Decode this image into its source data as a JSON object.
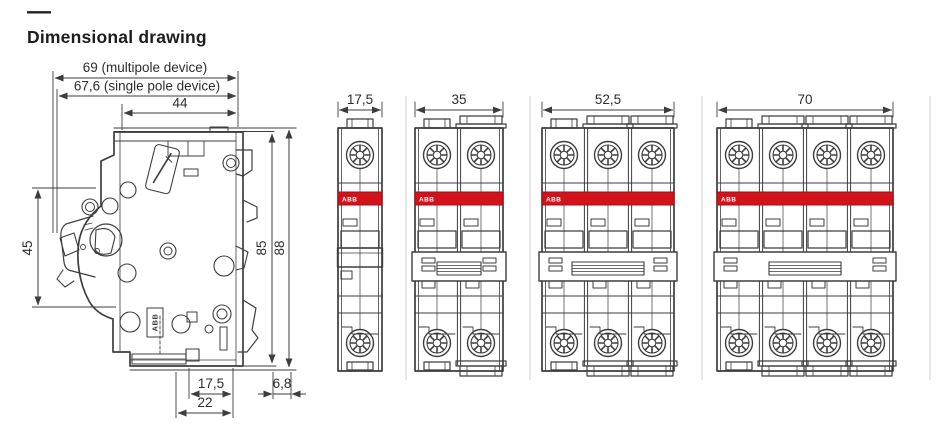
{
  "header": {
    "dash": "—",
    "title": "Dimensional drawing"
  },
  "colors": {
    "line": "#3d3d3d",
    "dim_line": "#3d3d3d",
    "text": "#2d2d2d",
    "brand_red": "#d2131b",
    "brand_red_border": "#a80d13",
    "separator": "#cfcfcf",
    "white": "#ffffff"
  },
  "side_view": {
    "dims_top": [
      {
        "id": "dim-69",
        "label": "69 (multipole device)"
      },
      {
        "id": "dim-67-6",
        "label": "67,6 (single pole device)"
      },
      {
        "id": "dim-44",
        "label": "44"
      }
    ],
    "dim_left": {
      "label": "45"
    },
    "dims_right": [
      {
        "label": "85"
      },
      {
        "label": "88"
      }
    ],
    "dims_bottom": [
      {
        "label": "17,5"
      },
      {
        "label": "6,8"
      },
      {
        "label": "22"
      }
    ],
    "brand_label": "ABB"
  },
  "front_views": [
    {
      "poles": 1,
      "width_label": "17,5"
    },
    {
      "poles": 2,
      "width_label": "35"
    },
    {
      "poles": 3,
      "width_label": "52,5"
    },
    {
      "poles": 4,
      "width_label": "70"
    }
  ],
  "brand_band_label": "ABB"
}
